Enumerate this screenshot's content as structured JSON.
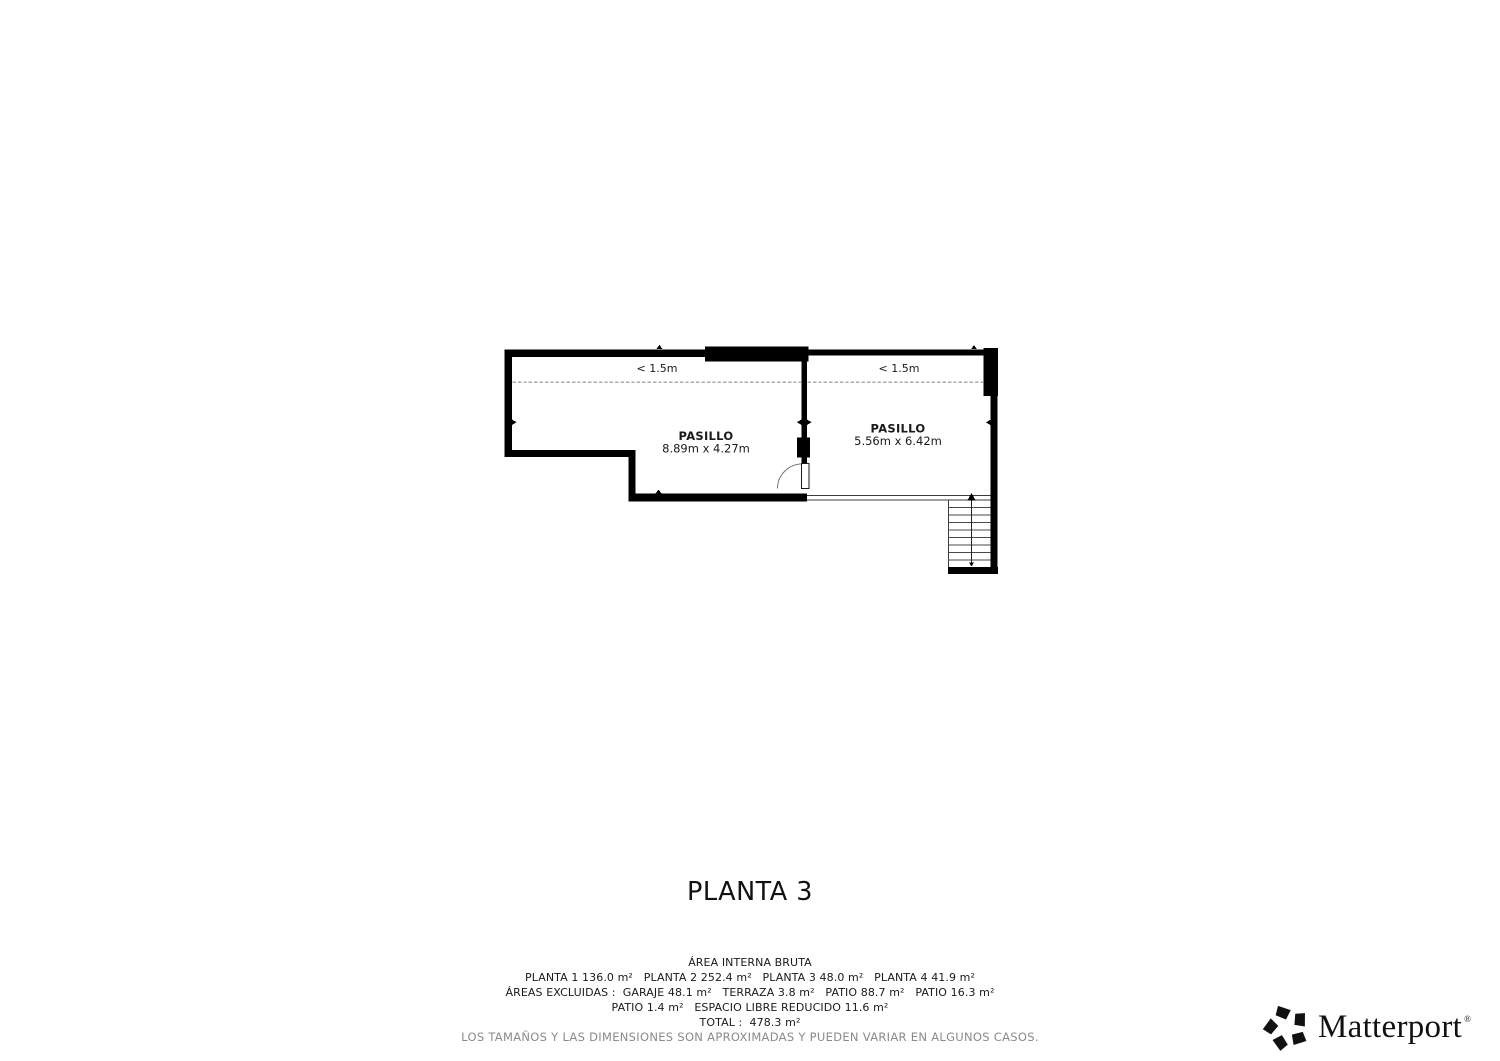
{
  "title": "PLANTA 3",
  "plan": {
    "low_ceiling_left": "< 1.5m",
    "low_ceiling_right": "< 1.5m",
    "rooms": [
      {
        "name": "PASILLO",
        "dimensions": "8.89m x 4.27m"
      },
      {
        "name": "PASILLO",
        "dimensions": "5.56m x 6.42m"
      }
    ]
  },
  "footer": {
    "heading": "ÁREA INTERNA BRUTA",
    "line_plantas": "PLANTA 1 136.0 m²   PLANTA 2 252.4 m²   PLANTA 3 48.0 m²   PLANTA 4 41.9 m²",
    "line_excluidas": "ÁREAS EXCLUIDAS :  GARAJE 48.1 m²   TERRAZA 3.8 m²   PATIO 88.7 m²   PATIO 16.3 m²",
    "line_patio": "PATIO 1.4 m²   ESPACIO LIBRE REDUCIDO 11.6 m²",
    "line_total": "TOTAL :  478.3 m²",
    "disclaimer": "LOS TAMAÑOS Y LAS DIMENSIONES SON APROXIMADAS Y PUEDEN VARIAR EN ALGUNOS CASOS."
  },
  "logo": {
    "brand": "Matterport",
    "registered": "®"
  },
  "colors": {
    "wall": "#000000",
    "dash": "#ababab",
    "thin_line": "#3d3d3d",
    "muted": "#8a8a8a"
  }
}
